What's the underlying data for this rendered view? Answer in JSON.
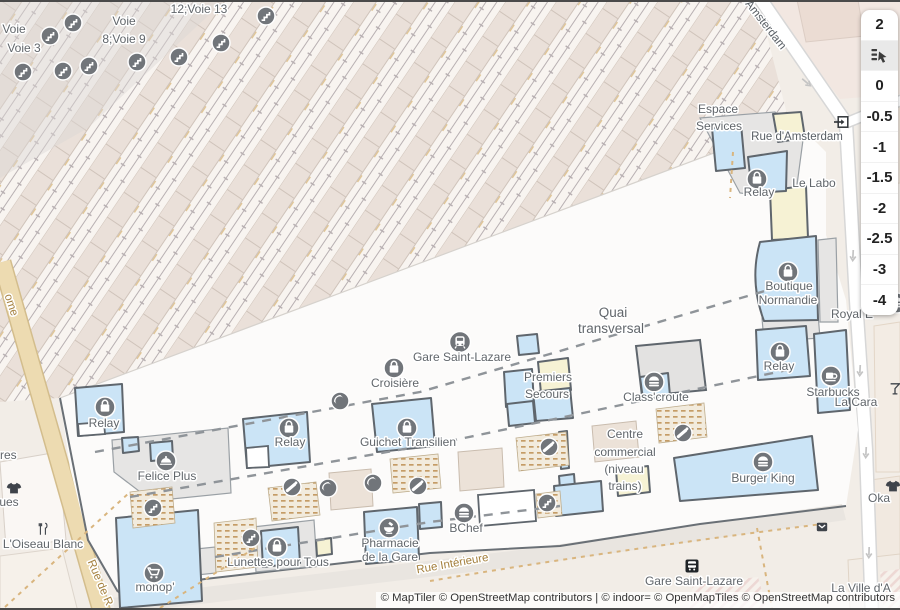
{
  "ui": {
    "level_control": {
      "items": [
        {
          "label": "2"
        },
        {
          "icon": "floor-picker-hand",
          "active": true
        },
        {
          "label": "0"
        },
        {
          "label": "-0.5"
        },
        {
          "label": "-1"
        },
        {
          "label": "-1.5"
        },
        {
          "label": "-2"
        },
        {
          "label": "-2.5"
        },
        {
          "label": "-3"
        },
        {
          "label": "-4"
        }
      ]
    },
    "attribution": "© MapTiler © OpenStreetMap contributors | © indoor= © OpenMapTiles © OpenStreetMap contributors"
  },
  "map": {
    "colors": {
      "shop_fill": "#cbe4f6",
      "shop_outline": "#5f666d",
      "room_yellow": "#f6f2d4",
      "platform": "#eae0d9",
      "street_tan": "#eddbb1",
      "poi_circle": "#71757a",
      "poi_label": "#61666b",
      "street_label": "#a5813f"
    },
    "labels": [
      {
        "text": "Voie",
        "x": 14,
        "y": 33
      },
      {
        "text": "Voie 3",
        "x": 24,
        "y": 52
      },
      {
        "text": "Voie",
        "x": 124,
        "y": 25
      },
      {
        "text": "8;Voie 9",
        "x": 124,
        "y": 43
      },
      {
        "text": "12;Voie 13",
        "x": 199,
        "y": 13
      },
      {
        "text": "Espace",
        "x": 718,
        "y": 113
      },
      {
        "text": "Services",
        "x": 719,
        "y": 130
      },
      {
        "text": "Rue d'Amsterdam",
        "x": 797,
        "y": 140,
        "anchor": "start",
        "kind": "streetdark"
      },
      {
        "text": "Relay",
        "x": 759,
        "y": 196
      },
      {
        "text": "Le Labo",
        "x": 814,
        "y": 187
      },
      {
        "text": "Boutique",
        "x": 789,
        "y": 290
      },
      {
        "text": "Normandie",
        "x": 788,
        "y": 304
      },
      {
        "text": "Relay",
        "x": 779,
        "y": 370
      },
      {
        "text": "Starbucks",
        "x": 833,
        "y": 396
      },
      {
        "text": "Royal E",
        "x": 852,
        "y": 318,
        "anchor": "start"
      },
      {
        "text": "La Cara",
        "x": 856,
        "y": 406,
        "anchor": "start"
      },
      {
        "text": "Quai",
        "x": 613,
        "y": 317,
        "kind": "big"
      },
      {
        "text": "transversal",
        "x": 611,
        "y": 333,
        "kind": "big"
      },
      {
        "text": "Gare Saint-Lazare",
        "x": 462,
        "y": 361
      },
      {
        "text": "Croisière",
        "x": 395,
        "y": 387
      },
      {
        "text": "Premiers",
        "x": 548,
        "y": 381
      },
      {
        "text": "Secours",
        "x": 547,
        "y": 398
      },
      {
        "text": "Class'croute",
        "x": 656,
        "y": 401
      },
      {
        "text": "Relay",
        "x": 290,
        "y": 446
      },
      {
        "text": "Guichet Transilien",
        "x": 408,
        "y": 446
      },
      {
        "text": "Centre",
        "x": 625,
        "y": 438
      },
      {
        "text": "commercial",
        "x": 625,
        "y": 456
      },
      {
        "text": "(niveau",
        "x": 624,
        "y": 473
      },
      {
        "text": "trains)",
        "x": 625,
        "y": 490
      },
      {
        "text": "Burger King",
        "x": 763,
        "y": 482
      },
      {
        "text": "Felice Plus",
        "x": 167,
        "y": 480
      },
      {
        "text": "Relay",
        "x": 104,
        "y": 427
      },
      {
        "text": "monop'",
        "x": 155,
        "y": 591
      },
      {
        "text": "Lunettes pour Tous",
        "x": 278,
        "y": 566
      },
      {
        "text": "Pharmacie",
        "x": 390,
        "y": 547
      },
      {
        "text": "de la Gare",
        "x": 390,
        "y": 561
      },
      {
        "text": "BChef",
        "x": 466,
        "y": 532
      },
      {
        "text": "L'Oiseau Blanc",
        "x": 43,
        "y": 548
      },
      {
        "text": "amarques",
        "x": -8,
        "y": 506,
        "anchor": "start"
      },
      {
        "text": "à Cigares",
        "x": -9,
        "y": 459,
        "anchor": "start"
      },
      {
        "text": "Oka",
        "x": 879,
        "y": 502,
        "anchor": "start"
      },
      {
        "text": "La Ville d'A",
        "x": 861,
        "y": 592,
        "anchor": "start"
      },
      {
        "text": "Gare Saint-Lazare",
        "x": 694,
        "y": 585
      },
      {
        "text": "Rue Intérieure",
        "x": 453,
        "y": 567,
        "rotate": -10,
        "kind": "street"
      },
      {
        "text": "Rue de R",
        "x": 97,
        "y": 584,
        "rotate": 67,
        "kind": "street"
      },
      {
        "text": "ome",
        "x": 8,
        "y": 306,
        "rotate": 72,
        "kind": "street"
      },
      {
        "text": "Amsterdam",
        "x": 763,
        "y": 27,
        "rotate": 52,
        "kind": "streetdark"
      }
    ],
    "pois": [
      {
        "icon": "stairs",
        "x": 23,
        "y": 72
      },
      {
        "icon": "stairs",
        "x": 50,
        "y": 36
      },
      {
        "icon": "stairs",
        "x": 73,
        "y": 23
      },
      {
        "icon": "stairs",
        "x": 63,
        "y": 71
      },
      {
        "icon": "stairs",
        "x": 89,
        "y": 66
      },
      {
        "icon": "stairs",
        "x": 137,
        "y": 62
      },
      {
        "icon": "stairs",
        "x": 179,
        "y": 57
      },
      {
        "icon": "stairs",
        "x": 221,
        "y": 43
      },
      {
        "icon": "stairs",
        "x": 266,
        "y": 16
      },
      {
        "icon": "stairs",
        "x": 153,
        "y": 508
      },
      {
        "icon": "stairs",
        "x": 251,
        "y": 538
      },
      {
        "icon": "stairs",
        "x": 547,
        "y": 503
      },
      {
        "icon": "escalator",
        "x": 292,
        "y": 487
      },
      {
        "icon": "escalator",
        "x": 418,
        "y": 486
      },
      {
        "icon": "escalator",
        "x": 683,
        "y": 433
      },
      {
        "icon": "escalator",
        "x": 549,
        "y": 447
      },
      {
        "icon": "phone",
        "x": 340,
        "y": 401
      },
      {
        "icon": "phone",
        "x": 328,
        "y": 488
      },
      {
        "icon": "phone",
        "x": 373,
        "y": 483
      },
      {
        "icon": "shopping-bag",
        "x": 757,
        "y": 179
      },
      {
        "icon": "shopping-bag",
        "x": 788,
        "y": 272
      },
      {
        "icon": "shopping-bag",
        "x": 780,
        "y": 352
      },
      {
        "icon": "shopping-bag",
        "x": 394,
        "y": 368
      },
      {
        "icon": "shopping-bag",
        "x": 289,
        "y": 428
      },
      {
        "icon": "shopping-bag",
        "x": 407,
        "y": 428
      },
      {
        "icon": "shopping-bag",
        "x": 105,
        "y": 407
      },
      {
        "icon": "shopping-bag",
        "x": 277,
        "y": 547
      },
      {
        "icon": "fast-food",
        "x": 654,
        "y": 382
      },
      {
        "icon": "fast-food",
        "x": 763,
        "y": 462
      },
      {
        "icon": "fast-food",
        "x": 464,
        "y": 513
      },
      {
        "icon": "fast-food",
        "x": 897,
        "y": 303
      },
      {
        "icon": "coffee",
        "x": 831,
        "y": 376
      },
      {
        "icon": "shopping-cart",
        "x": 154,
        "y": 573
      },
      {
        "icon": "pharmacy",
        "x": 389,
        "y": 528
      },
      {
        "icon": "train-station",
        "x": 460,
        "y": 342
      },
      {
        "icon": "bus-stop",
        "x": 692,
        "y": 566
      },
      {
        "icon": "food-cloche",
        "x": 166,
        "y": 461
      },
      {
        "icon": "entrance",
        "x": 843,
        "y": 122
      },
      {
        "icon": "clothing",
        "x": 14,
        "y": 488
      },
      {
        "icon": "clothing",
        "x": 893,
        "y": 486
      },
      {
        "icon": "restaurant",
        "x": 43,
        "y": 529
      },
      {
        "icon": "cocktail",
        "x": 895,
        "y": 389
      },
      {
        "icon": "post-box",
        "x": 822,
        "y": 527
      },
      {
        "icon": "road-arrow",
        "x": 806,
        "y": 82,
        "rotate": -50
      },
      {
        "icon": "road-arrow",
        "x": 853,
        "y": 255,
        "rotate": 3
      },
      {
        "icon": "road-arrow",
        "x": 860,
        "y": 370,
        "rotate": 3
      },
      {
        "icon": "road-arrow",
        "x": 866,
        "y": 452,
        "rotate": 3
      },
      {
        "icon": "road-arrow",
        "x": 869,
        "y": 552,
        "rotate": 2
      }
    ]
  }
}
